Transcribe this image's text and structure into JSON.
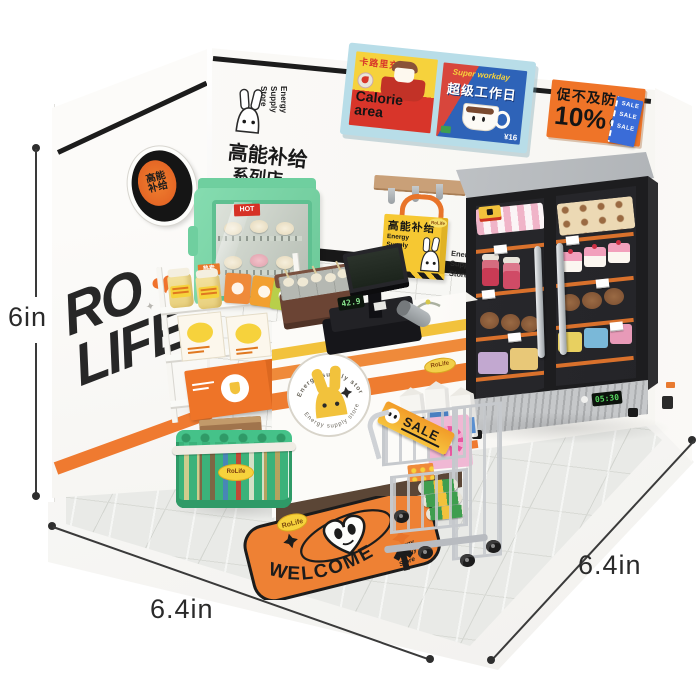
{
  "dimensions": {
    "height_label": "6in",
    "width_label": "6.4in",
    "depth_label": "6.4in"
  },
  "branding": {
    "rolife_line1": "RO",
    "rolife_line2": "LIFE",
    "badge_cn": "高能补给",
    "store_name_en": "Energy\nSupply\nStore",
    "store_name_cn": "高能补给",
    "store_branch_cn": "系列店",
    "rolife_sticker": "RoLife"
  },
  "icons": {
    "heart": "❤",
    "spark": "✦"
  },
  "posters": {
    "calorie_header_cn": "卡路里充值",
    "calorie_title_line1": "Calorie",
    "calorie_title_line2": "area",
    "workday_tagline": "Super workday",
    "workday_title_cn": "超级工作日",
    "workday_price": "¥16",
    "discount_cn": "促不及防",
    "discount_percent": "10%",
    "discount_off": "OFF",
    "ticket_text": "SALE SALE SALE"
  },
  "wall": {
    "tile_sign": "Energy\nSupply\nStore",
    "bag_cn": "高能补给",
    "bag_en": "Energy\nSupply\nStore"
  },
  "hot_case": {
    "hot_label": "HOT",
    "tag_label": "热卖"
  },
  "counter": {
    "badge_arc_text": "Energy supply store",
    "register_display": "42.9"
  },
  "fridge": {
    "panel_display": "05:30"
  },
  "cart": {
    "sale_label": "SALE"
  },
  "mat": {
    "welcome_text": "WELCOME",
    "store_text": "Energy\nSupply\nStore"
  }
}
